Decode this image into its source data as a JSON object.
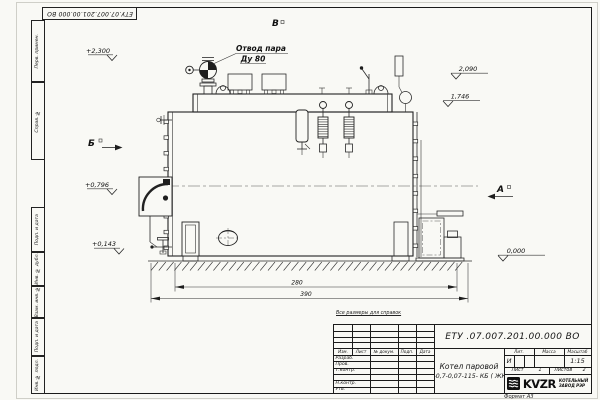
{
  "sheet": {
    "designation_top": "ЕТУ.07.007.201.00.000 ВО",
    "reference_note": "Все размеры для справок",
    "format_note": "Формат А3",
    "margin_columns": [
      "Перв. примен.",
      "Справ. №",
      "Подп. и дата",
      "Инв. № дубл.",
      "Взам. инв. №",
      "Подп. и дата",
      "Инв. № подл."
    ]
  },
  "title_block": {
    "designation": "ЕТУ .07.007.201.00.000  ВО",
    "name_line1": "Котел паровой",
    "name_line2": "Е -0,7-0,07-115- КБ ( ЖК )",
    "header_izm": "Изм.",
    "header_list": "Лист",
    "header_doc": "№ докум.",
    "header_sign": "Подп.",
    "header_date": "Дата",
    "staff_rows": [
      "Разраб.",
      "Пров.",
      "Т.контр.",
      "",
      "Н.контр.",
      "Утв."
    ],
    "lit_label": "Лит.",
    "mass_label": "Масса",
    "scale_label": "Масштаб",
    "lit_value": "И",
    "scale_value": "1:15",
    "sheet_label": "Лист",
    "sheet_value": "1",
    "sheets_label": "Листов",
    "sheets_value": "2",
    "logo_text": "KVZR",
    "logo_caption1": "КОТЕЛЬНЫЙ",
    "logo_caption2": "ЗАВОД РЭР"
  },
  "drawing": {
    "steam_label1": "Отвод пара",
    "steam_label2": "Ду 80",
    "view_a": "А",
    "view_b": "Б",
    "view_v": "В",
    "elev": {
      "top_left": "+2,300",
      "left_mid": "+0,796",
      "left_low": "+0,143",
      "right_upper": "2,090",
      "right_mid": "1,746",
      "base": "0,000"
    },
    "dims": {
      "inner": "280",
      "total": "390"
    }
  }
}
